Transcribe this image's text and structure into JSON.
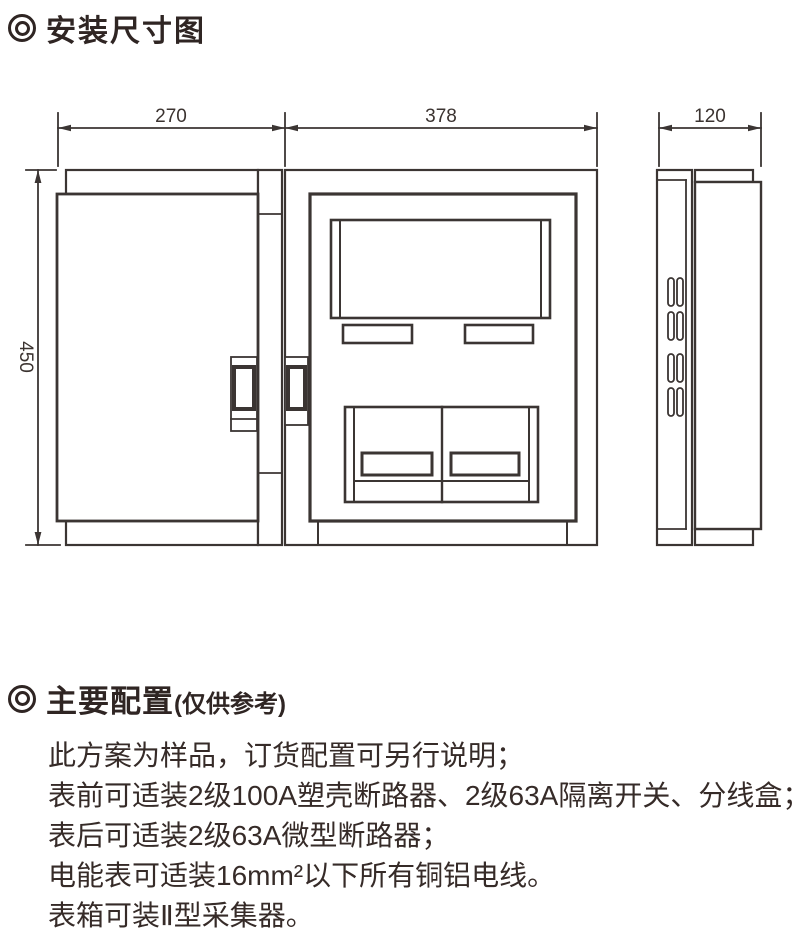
{
  "colors": {
    "ink": "#352a27",
    "line": "#3b3533",
    "background": "#ffffff"
  },
  "section_install": {
    "title": "安装尺寸图"
  },
  "drawing": {
    "dimensions": {
      "door_width": "270",
      "box_width": "378",
      "depth": "120",
      "height": "450"
    }
  },
  "section_config": {
    "title": "主要配置",
    "title_suffix": "(仅供参考)",
    "lines": [
      "此方案为样品，订货配置可另行说明；",
      "表前可适装2级100A塑壳断路器、2级63A隔离开关、分线盒；",
      "表后可适装2级63A微型断路器；",
      "电能表可适装16mm²以下所有铜铝电线。",
      "表箱可装Ⅱ型采集器。"
    ]
  }
}
